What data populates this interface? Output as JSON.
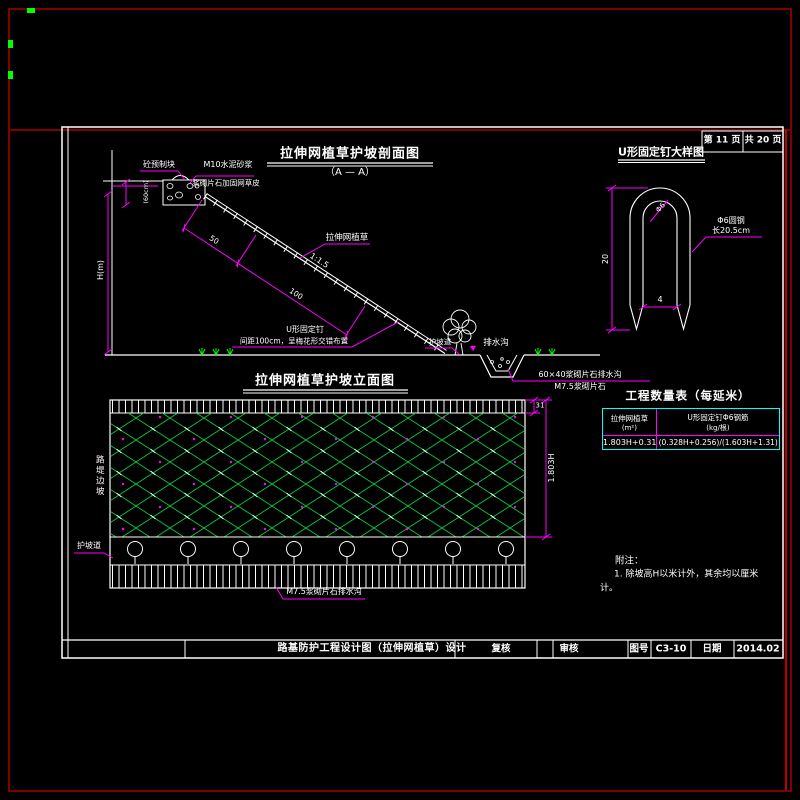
{
  "page": {
    "header": {
      "page_label": "第 11 页",
      "total_label": "共 20 页"
    },
    "title_bar": {
      "title": "路基防护工程设计图（拉伸网植草）设计",
      "check_label": "复核",
      "review_label": "审核",
      "drawing_no_label": "图号",
      "drawing_no_value": "C3-10",
      "date_label": "日期",
      "date_value": "2014.02"
    }
  },
  "section_view": {
    "title": "拉伸网植草护坡剖面图",
    "subtitle": "（A — A）",
    "labels": {
      "precast_block": "砼预制块",
      "mortar": "M10水泥砂浆",
      "masonry": "浆砌片石加固网草皮",
      "block_height": "(60cm)",
      "slope_height": "H(m)",
      "dim_50": "50",
      "dim_100": "100",
      "slope_ratio": "1:1.5",
      "mesh_label": "拉伸网植草",
      "nail_label": "U形固定钉",
      "nail_note": "间距100cm，呈梅花形交错布置",
      "berm": "护坡道",
      "ditch": "排水沟",
      "ditch_spec": "60×40浆砌片石排水沟",
      "ditch_material": "M7.5浆砌片石"
    }
  },
  "elevation_view": {
    "title": "拉伸网植草护坡立面图",
    "labels": {
      "left_vertical": "路堤边坡",
      "berm": "护坡道",
      "ditch": "M7.5浆砌片石排水沟",
      "dim_top": "31",
      "dim_side": "1.803H"
    }
  },
  "detail_view": {
    "title": "U形固定钉大样图",
    "labels": {
      "dim_height": "20",
      "dim_width": "4",
      "bar_dia": "Φ6",
      "material_line1": "Φ6圆钢",
      "material_line2": "长20.5cm"
    }
  },
  "quantity_table": {
    "title": "工程数量表（每延米）",
    "col1_header_line1": "拉伸网植草",
    "col1_header_line2": "(m²)",
    "col2_header_line1": "U形固定钉Φ6钢筋",
    "col2_header_line2": "(kg/根)",
    "col1_value": "1.803H+0.31",
    "col2_value": "(0.328H+0.256)/(1.603H+1.31)"
  },
  "notes": {
    "heading": "附注：",
    "line1": "1. 除坡高H以米计外，其余均以厘米",
    "line2": "计。"
  },
  "colors": {
    "background": "#000000",
    "linework": "#ffffff",
    "dimension": "#ff00ff",
    "mesh_green": "#00dd44",
    "grass_green": "#00ff00",
    "table_border": "#00ffff",
    "outer_frame": "#800000",
    "inner_frame_red": "#ff0000"
  }
}
